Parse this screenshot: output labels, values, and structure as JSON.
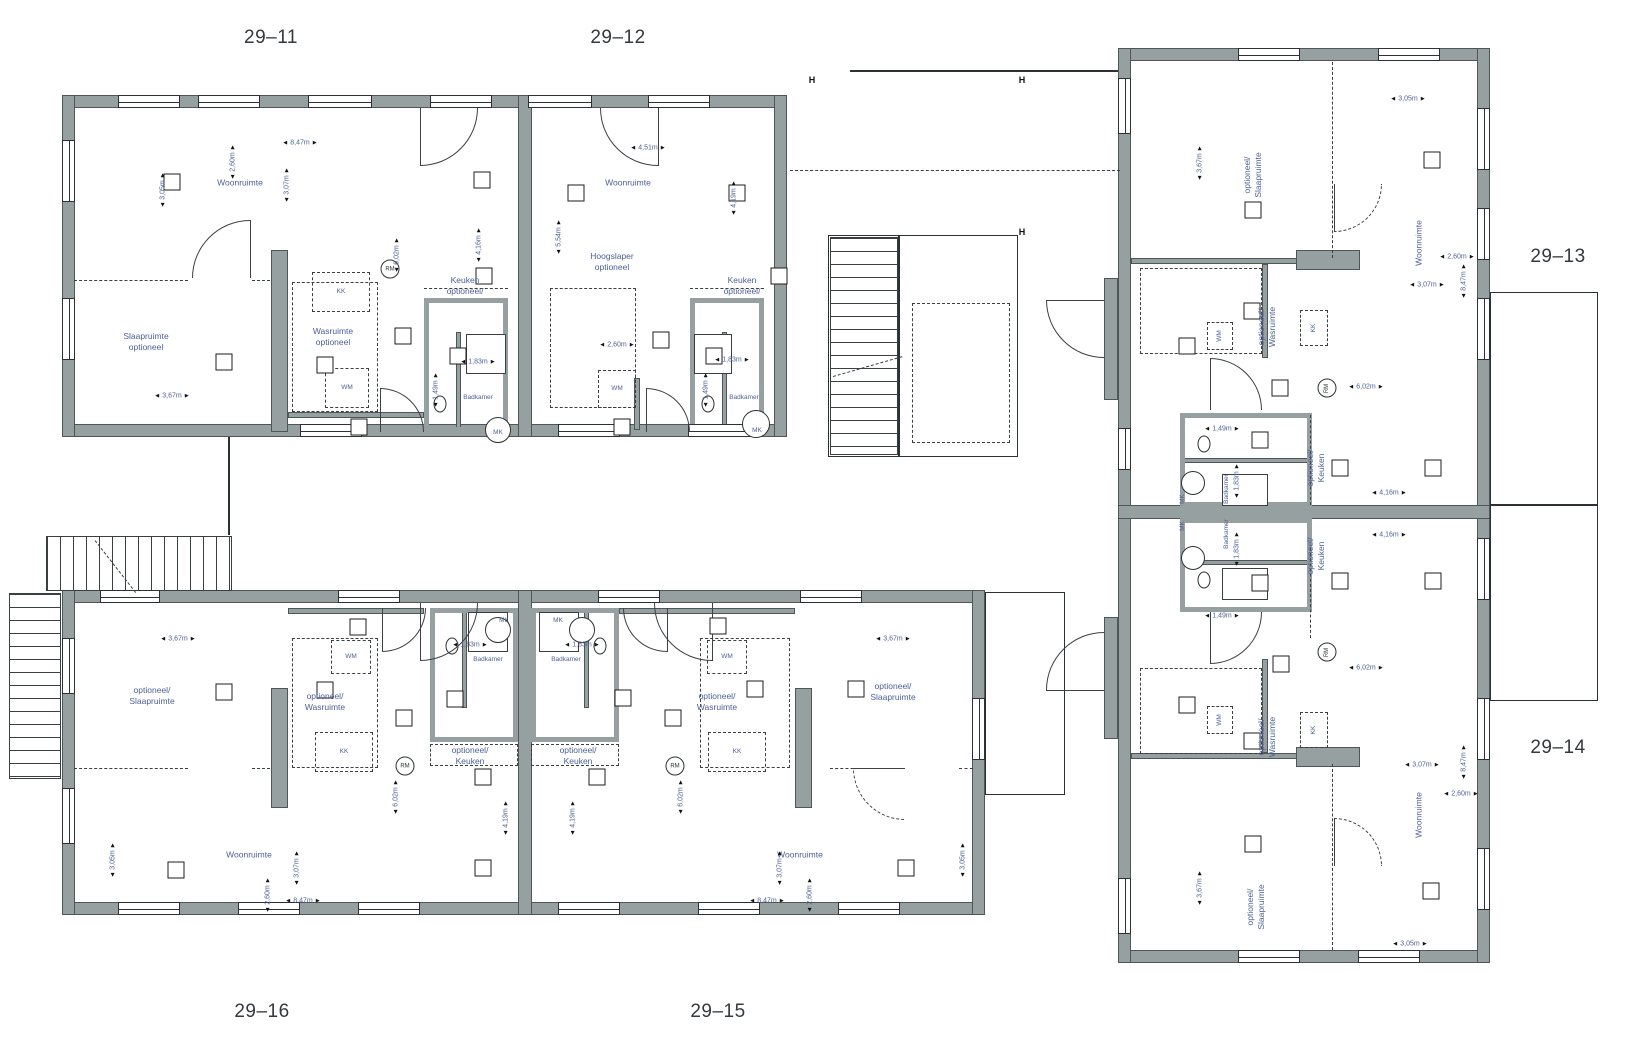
{
  "drawing_type": "floor-plan",
  "colors": {
    "wall": "#96a0a0",
    "wall_edge": "#4e5658",
    "line": "#2c3133",
    "annotation_text": "#4d6096",
    "unit_text": "#33393d",
    "background": "#ffffff"
  },
  "units": [
    [
      "29–11",
      271,
      38
    ],
    [
      "29–12",
      618,
      38
    ],
    [
      "29–13",
      1558,
      257
    ],
    [
      "29–14",
      1558,
      748
    ],
    [
      "29–15",
      718,
      1012
    ],
    [
      "29–16",
      262,
      1012
    ]
  ],
  "rooms": [
    [
      "Woonruimte",
      240,
      183,
      ""
    ],
    [
      "Slaapruimte\noptioneel",
      146,
      342,
      ""
    ],
    [
      "Wasruimte\noptioneel",
      333,
      337,
      ""
    ],
    [
      "Keuken\noptioneel/",
      465,
      286,
      ""
    ],
    [
      "Badkamer",
      478,
      398,
      "s"
    ],
    [
      "KK",
      341,
      292,
      "s"
    ],
    [
      "WM",
      347,
      388,
      "s"
    ],
    [
      "MK",
      498,
      433,
      "s"
    ],
    [
      "Woonruimte",
      628,
      183,
      ""
    ],
    [
      "Hoogslaper\noptioneel",
      612,
      262,
      ""
    ],
    [
      "Keuken\noptioneel/",
      742,
      286,
      ""
    ],
    [
      "Badkamer",
      744,
      398,
      "s"
    ],
    [
      "WM",
      617,
      389,
      "s"
    ],
    [
      "MK",
      757,
      431,
      "s"
    ],
    [
      "optioneel/\nSlaapruimte",
      152,
      696,
      ""
    ],
    [
      "optioneel/\nWasruimte",
      325,
      702,
      ""
    ],
    [
      "optioneel/\nKeuken",
      470,
      756,
      ""
    ],
    [
      "Woonruimte",
      249,
      855,
      ""
    ],
    [
      "Badkamer",
      488,
      660,
      "s"
    ],
    [
      "KK",
      344,
      752,
      "s"
    ],
    [
      "WM",
      351,
      657,
      "s"
    ],
    [
      "MK",
      504,
      621,
      "s"
    ],
    [
      "optioneel/\nSlaapruimte",
      893,
      692,
      ""
    ],
    [
      "optioneel/\nWasruimte",
      717,
      702,
      ""
    ],
    [
      "optioneel/\nKeuken",
      578,
      756,
      ""
    ],
    [
      "Woonruimte",
      800,
      855,
      ""
    ],
    [
      "Badkamer",
      566,
      660,
      "s"
    ],
    [
      "KK",
      737,
      752,
      "s"
    ],
    [
      "WM",
      727,
      657,
      "s"
    ],
    [
      "MK",
      558,
      621,
      "s"
    ],
    [
      "optioneel/\nSlaapruimte",
      1253,
      175,
      "r"
    ],
    [
      "Woonruimte",
      1419,
      243,
      "r"
    ],
    [
      "optioneel/\nWasruimte",
      1267,
      327,
      "r"
    ],
    [
      "optioneel/\nKeuken",
      1316,
      468,
      "r"
    ],
    [
      "Badkamer",
      1227,
      489,
      "sr"
    ],
    [
      "WM",
      1220,
      336,
      "sr"
    ],
    [
      "KK",
      1314,
      328,
      "sr"
    ],
    [
      "MK",
      1183,
      499,
      "sr"
    ],
    [
      "optioneel/\nKeuken",
      1316,
      556,
      "r"
    ],
    [
      "Badkamer",
      1227,
      534,
      "sr"
    ],
    [
      "MK",
      1183,
      526,
      "sr"
    ],
    [
      "optioneel/\nWasruimte",
      1267,
      737,
      "r"
    ],
    [
      "WM",
      1220,
      720,
      "sr"
    ],
    [
      "KK",
      1314,
      730,
      "sr"
    ],
    [
      "Woonruimte",
      1419,
      815,
      "r"
    ],
    [
      "optioneel/\nSlaapruimte",
      1256,
      907,
      "r"
    ]
  ],
  "dims": [
    [
      "8,47m",
      300,
      143,
      "h"
    ],
    [
      "2,60m",
      233,
      162,
      "v"
    ],
    [
      "3,05m",
      163,
      190,
      "v"
    ],
    [
      "3,07m",
      287,
      185,
      "v"
    ],
    [
      "6,02m",
      397,
      255,
      "v"
    ],
    [
      "4,16m",
      479,
      245,
      "v"
    ],
    [
      "3,67m",
      172,
      396,
      "h"
    ],
    [
      "1,83m",
      478,
      362,
      "h"
    ],
    [
      "1,49m",
      436,
      390,
      "v"
    ],
    [
      "4,51m",
      648,
      148,
      "h"
    ],
    [
      "5,54m",
      559,
      237,
      "v"
    ],
    [
      "4,19m",
      734,
      198,
      "v"
    ],
    [
      "2,60m",
      617,
      345,
      "h"
    ],
    [
      "1,83m",
      732,
      360,
      "h"
    ],
    [
      "1,49m",
      706,
      390,
      "v"
    ],
    [
      "3,67m",
      178,
      639,
      "h"
    ],
    [
      "3,05m",
      113,
      860,
      "v"
    ],
    [
      "3,07m",
      297,
      868,
      "v"
    ],
    [
      "2,60m",
      268,
      895,
      "v"
    ],
    [
      "8,47m",
      303,
      901,
      "h"
    ],
    [
      "6,02m",
      396,
      797,
      "v"
    ],
    [
      "4,19m",
      506,
      818,
      "v"
    ],
    [
      "1,83m",
      470,
      645,
      "h"
    ],
    [
      "3,67m",
      893,
      639,
      "h"
    ],
    [
      "3,05m",
      963,
      860,
      "v"
    ],
    [
      "3,07m",
      780,
      868,
      "v"
    ],
    [
      "2,60m",
      810,
      895,
      "v"
    ],
    [
      "8,47m",
      767,
      901,
      "h"
    ],
    [
      "6,02m",
      681,
      797,
      "v"
    ],
    [
      "4,19m",
      573,
      818,
      "v"
    ],
    [
      "1,83m",
      582,
      645,
      "h"
    ],
    [
      "3,05m",
      1408,
      99,
      "h"
    ],
    [
      "3,67m",
      1200,
      163,
      "v"
    ],
    [
      "2,60m",
      1457,
      257,
      "h"
    ],
    [
      "8,47m",
      1464,
      281,
      "v"
    ],
    [
      "3,07m",
      1427,
      285,
      "h"
    ],
    [
      "6,02m",
      1366,
      387,
      "h"
    ],
    [
      "4,16m",
      1389,
      493,
      "h"
    ],
    [
      "1,49m",
      1222,
      429,
      "h"
    ],
    [
      "1,83m",
      1237,
      481,
      "v"
    ],
    [
      "4,16m",
      1389,
      535,
      "h"
    ],
    [
      "1,49m",
      1222,
      616,
      "h"
    ],
    [
      "1,83m",
      1237,
      549,
      "v"
    ],
    [
      "6,02m",
      1366,
      668,
      "h"
    ],
    [
      "3,07m",
      1422,
      765,
      "h"
    ],
    [
      "8,47m",
      1464,
      762,
      "v"
    ],
    [
      "2,60m",
      1461,
      794,
      "h"
    ],
    [
      "3,67m",
      1200,
      888,
      "v"
    ],
    [
      "3,05m",
      1410,
      944,
      "h"
    ]
  ],
  "vents": [
    [
      172,
      182
    ],
    [
      482,
      180
    ],
    [
      484,
      276
    ],
    [
      403,
      336
    ],
    [
      325,
      365
    ],
    [
      224,
      362
    ],
    [
      458,
      356
    ],
    [
      359,
      427
    ],
    [
      576,
      193
    ],
    [
      737,
      193
    ],
    [
      779,
      276
    ],
    [
      661,
      340
    ],
    [
      714,
      356
    ],
    [
      622,
      427
    ],
    [
      358,
      627
    ],
    [
      224,
      692
    ],
    [
      325,
      690
    ],
    [
      404,
      718
    ],
    [
      455,
      699
    ],
    [
      483,
      777
    ],
    [
      176,
      870
    ],
    [
      483,
      868
    ],
    [
      718,
      626
    ],
    [
      755,
      689
    ],
    [
      856,
      689
    ],
    [
      673,
      718
    ],
    [
      623,
      698
    ],
    [
      597,
      777
    ],
    [
      906,
      868
    ],
    [
      1432,
      160
    ],
    [
      1253,
      210
    ],
    [
      1187,
      346
    ],
    [
      1252,
      311
    ],
    [
      1280,
      388
    ],
    [
      1340,
      468
    ],
    [
      1433,
      468
    ],
    [
      1260,
      440
    ],
    [
      1340,
      581
    ],
    [
      1433,
      581
    ],
    [
      1260,
      583
    ],
    [
      1281,
      664
    ],
    [
      1187,
      705
    ],
    [
      1252,
      741
    ],
    [
      1253,
      844
    ],
    [
      1431,
      891
    ]
  ],
  "detectors": [
    [
      390,
      269,
      0,
      "RM"
    ],
    [
      405,
      766,
      0,
      "RM"
    ],
    [
      675,
      766,
      0,
      "RM"
    ],
    [
      1327,
      388,
      1,
      "RM"
    ],
    [
      1327,
      652,
      1,
      "RM"
    ]
  ],
  "h_markers": [
    [
      812,
      80
    ],
    [
      1022,
      80
    ],
    [
      1022,
      232
    ]
  ]
}
